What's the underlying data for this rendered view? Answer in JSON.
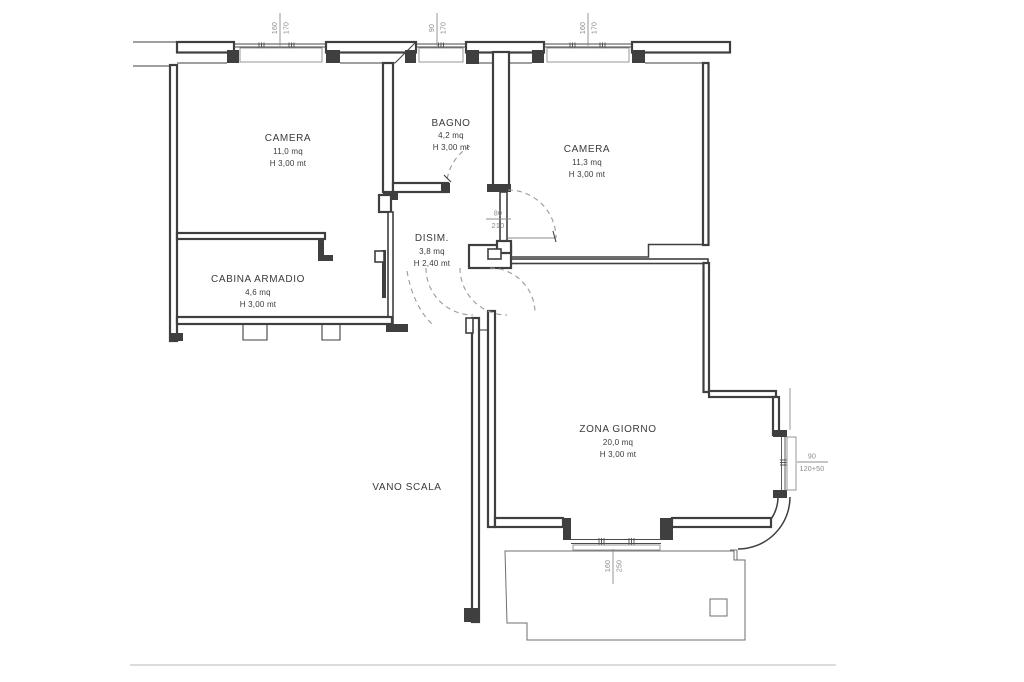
{
  "rooms": {
    "camera1": {
      "name": "CAMERA",
      "area": "11,0 mq",
      "height": "H 3,00 mt"
    },
    "bagno": {
      "name": "BAGNO",
      "area": "4,2 mq",
      "height": "H 3,00 mt"
    },
    "camera2": {
      "name": "CAMERA",
      "area": "11,3 mq",
      "height": "H 3,00 mt"
    },
    "disim": {
      "name": "DISIM.",
      "area": "3,8 mq",
      "height": "H 2,40 mt"
    },
    "cabina": {
      "name": "CABINA ARMADIO",
      "area": "4,6 mq",
      "height": "H 3,00 mt"
    },
    "zona": {
      "name": "ZONA GIORNO",
      "area": "20,0 mq",
      "height": "H 3,00 mt"
    },
    "vano_scala": {
      "name": "VANO SCALA"
    }
  },
  "dims": {
    "window_top_left": {
      "w": "160",
      "h": "170"
    },
    "window_top_center": {
      "w": "90",
      "h": "170"
    },
    "window_top_right": {
      "w": "160",
      "h": "170"
    },
    "door_hall": {
      "w": "80",
      "h": "210"
    },
    "window_right": {
      "w": "90",
      "h": "120+50"
    },
    "window_bottom": {
      "w": "160",
      "h": "250"
    }
  },
  "colors": {
    "wall": "#3f3f3f",
    "dim_text": "#8a8a8a",
    "label_text": "#3b3b3b",
    "light_line": "#dcdcdc"
  }
}
